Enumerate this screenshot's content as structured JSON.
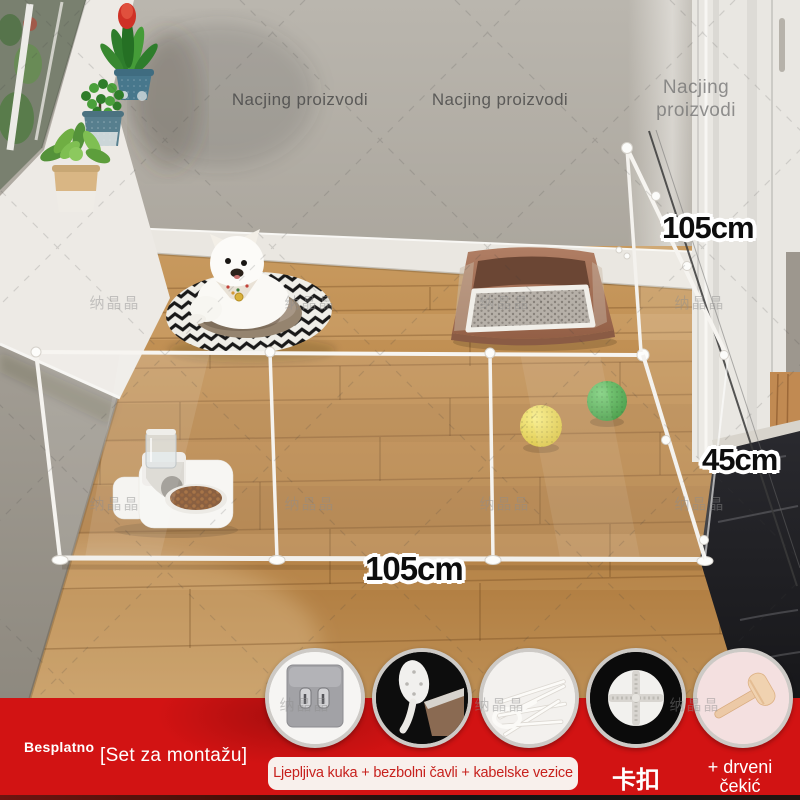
{
  "watermarks": {
    "brand": "Nacjing proizvodi",
    "cn": "纳晶晶"
  },
  "dimensions": {
    "gate_height": "105cm",
    "fence_height": "45cm",
    "fence_length": "105cm"
  },
  "banner": {
    "free_label": "Besplatno",
    "set_label": "[Set za montažu]",
    "included_strip": "Ljepljiva kuka + bezbolni čavli + kabelske vezice +",
    "buckle_label": "卡扣",
    "hammer_label_line1": "+ drveni",
    "hammer_label_line2": "čekić",
    "colors": {
      "banner_red": "#d21313",
      "strip_bg": "#f8f0ec",
      "strip_text": "#c7211d",
      "circle_border": "#cdcac6"
    },
    "icons": [
      {
        "name": "adhesive-hook"
      },
      {
        "name": "painless-nail"
      },
      {
        "name": "cable-ties"
      },
      {
        "name": "cross-buckle"
      },
      {
        "name": "wooden-hammer"
      }
    ]
  }
}
